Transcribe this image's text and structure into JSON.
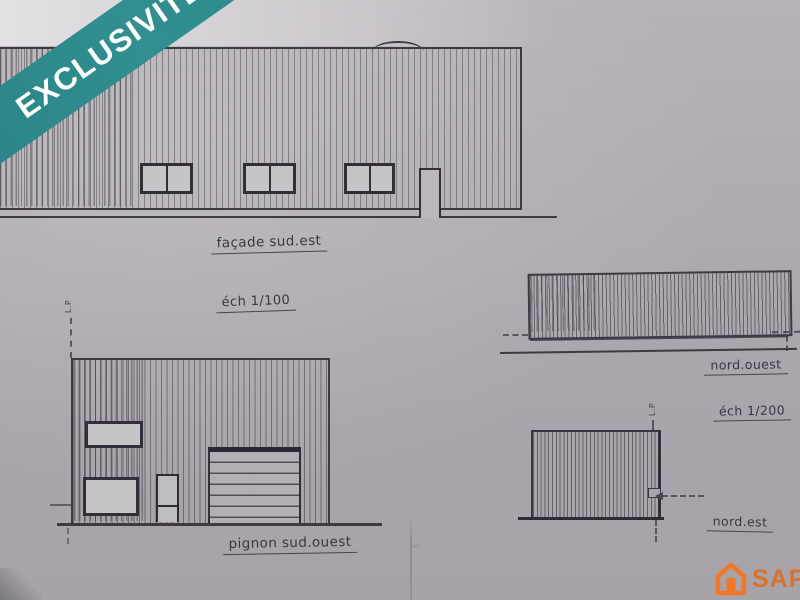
{
  "banner": {
    "label": "EXCLUSIVITÉ"
  },
  "drawings": {
    "facade": {
      "caption": "façade  sud.est",
      "scale": "éch 1/100"
    },
    "pignon": {
      "caption": "pignon  sud.ouest"
    },
    "nord_ouest": {
      "caption": "nord.ouest",
      "scale": "éch 1/200"
    },
    "nord_est": {
      "caption": "nord.est"
    }
  },
  "marks": {
    "property_line": "L.P"
  },
  "logo": {
    "brand": "SAFTI"
  },
  "colors": {
    "banner_teal": "#2e8c8e",
    "logo_orange": "#f1772a",
    "ink": "#3d3a44",
    "paper": "#aba6ad"
  }
}
